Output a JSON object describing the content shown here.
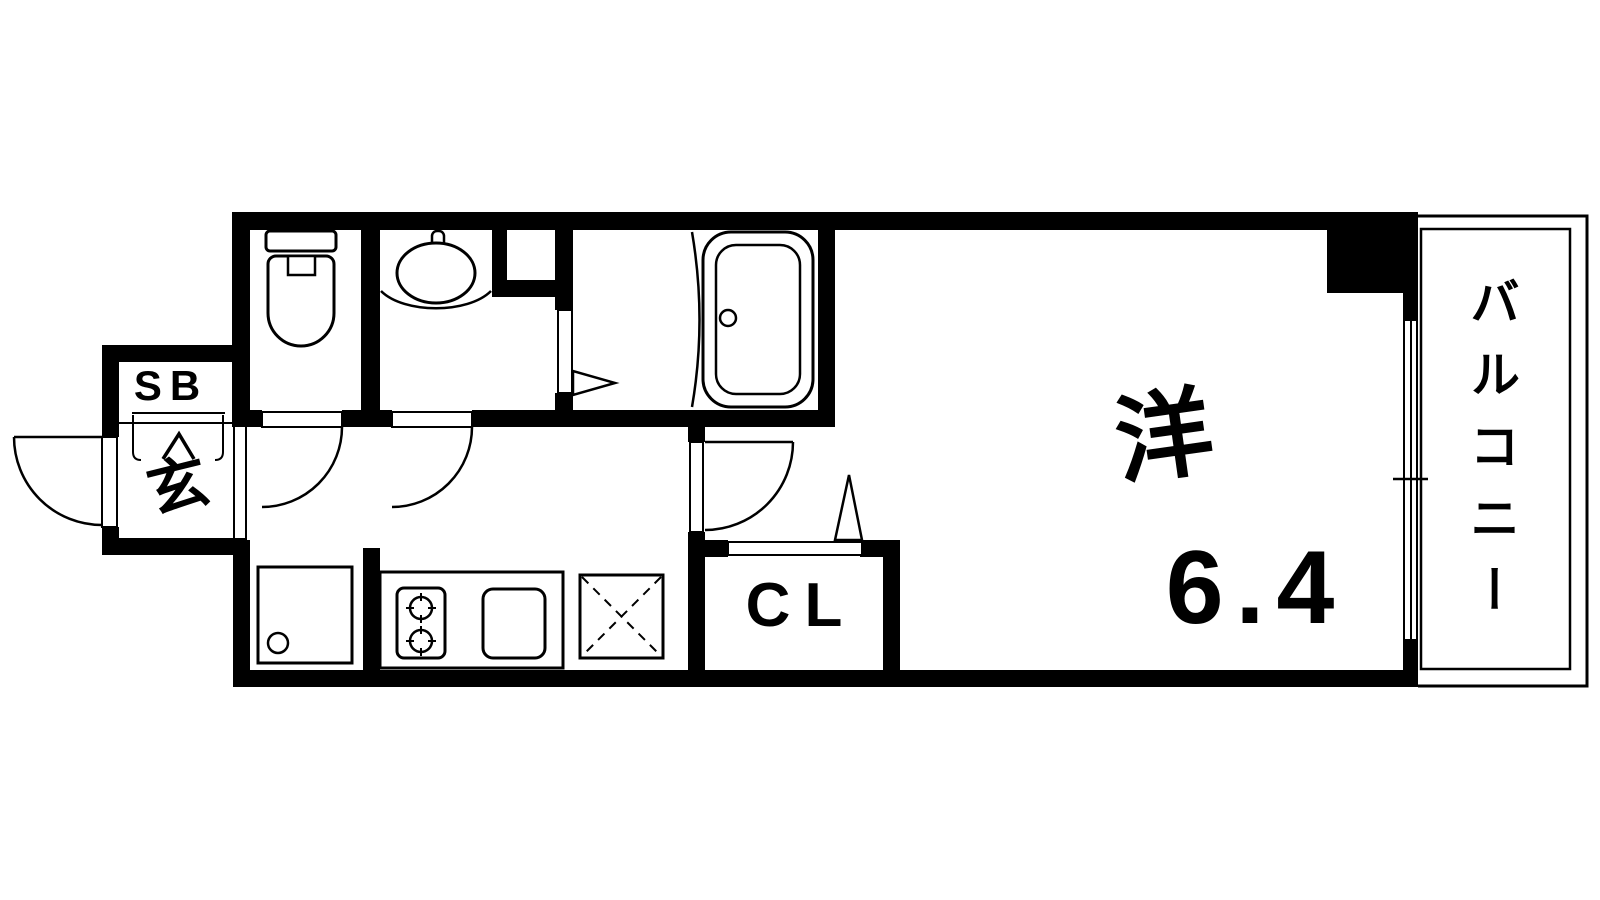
{
  "colors": {
    "line": "#000000",
    "background": "#ffffff"
  },
  "rooms": {
    "western_room": {
      "label": "洋",
      "size": "6.4"
    },
    "balcony": {
      "label": "バルコニー"
    },
    "closet": {
      "label": "CL"
    },
    "shoe_box": {
      "label": "SB"
    },
    "entrance": {
      "label": "玄"
    }
  }
}
